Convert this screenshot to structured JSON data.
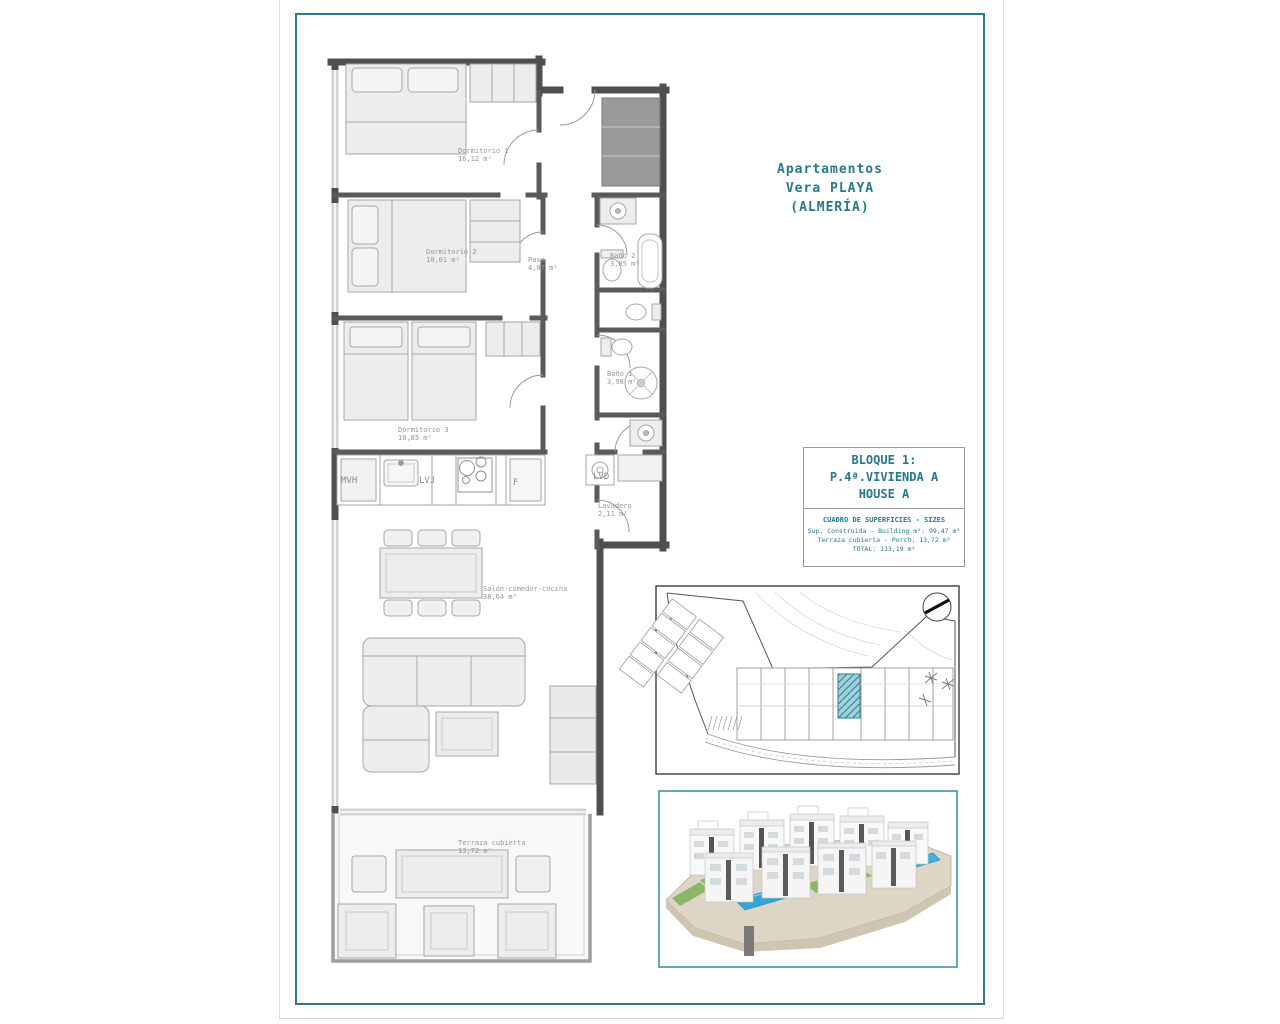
{
  "colors": {
    "accent": "#26798a",
    "frame": "#2f7889",
    "wall": "#4f4f4f",
    "highlight_unit": "#2c7d8f"
  },
  "header": {
    "line1": "Apartamentos",
    "line2": "Vera PLAYA",
    "line3": "(ALMERÍA)"
  },
  "info_box": {
    "block": "BLOQUE 1:",
    "unit": "P.4ª.VIVIENDA A",
    "house": "HOUSE A",
    "sizes_title": "CUADRO DE SUPERFICIES  - SIZES",
    "row_built": "Sup. Construida  - Building m²: 99,47 m²",
    "row_porch": "Terraza cubierta  - Porch: 13,72 m²",
    "row_total": "TOTAL: 113,19 m²"
  },
  "rooms": {
    "dormitorio1": {
      "name": "Dormitorio 1",
      "area": "16,12 m²"
    },
    "dormitorio2": {
      "name": "Dormitorio 2",
      "area": "10,01 m²"
    },
    "paso": {
      "name": "Paso",
      "area": "4,07 m²"
    },
    "bano2": {
      "name": "Baño 2",
      "area": "3,85 m²"
    },
    "dormitorio3": {
      "name": "Dormitorio 3",
      "area": "10,85 m²"
    },
    "bano1": {
      "name": "Baño 1",
      "area": "3,98 m²"
    },
    "lavadero": {
      "name": "Lavadero",
      "area": "2,11 m²"
    },
    "salon": {
      "name": "Salón-comedor-cocina",
      "area": "38,64 m²"
    },
    "terraza": {
      "name": "Terraza cubierta",
      "area": "13,72 m²"
    }
  },
  "appliances": {
    "mvh": "MVH",
    "lvj": "LVJ",
    "f": "F",
    "lvd": "LVD"
  }
}
